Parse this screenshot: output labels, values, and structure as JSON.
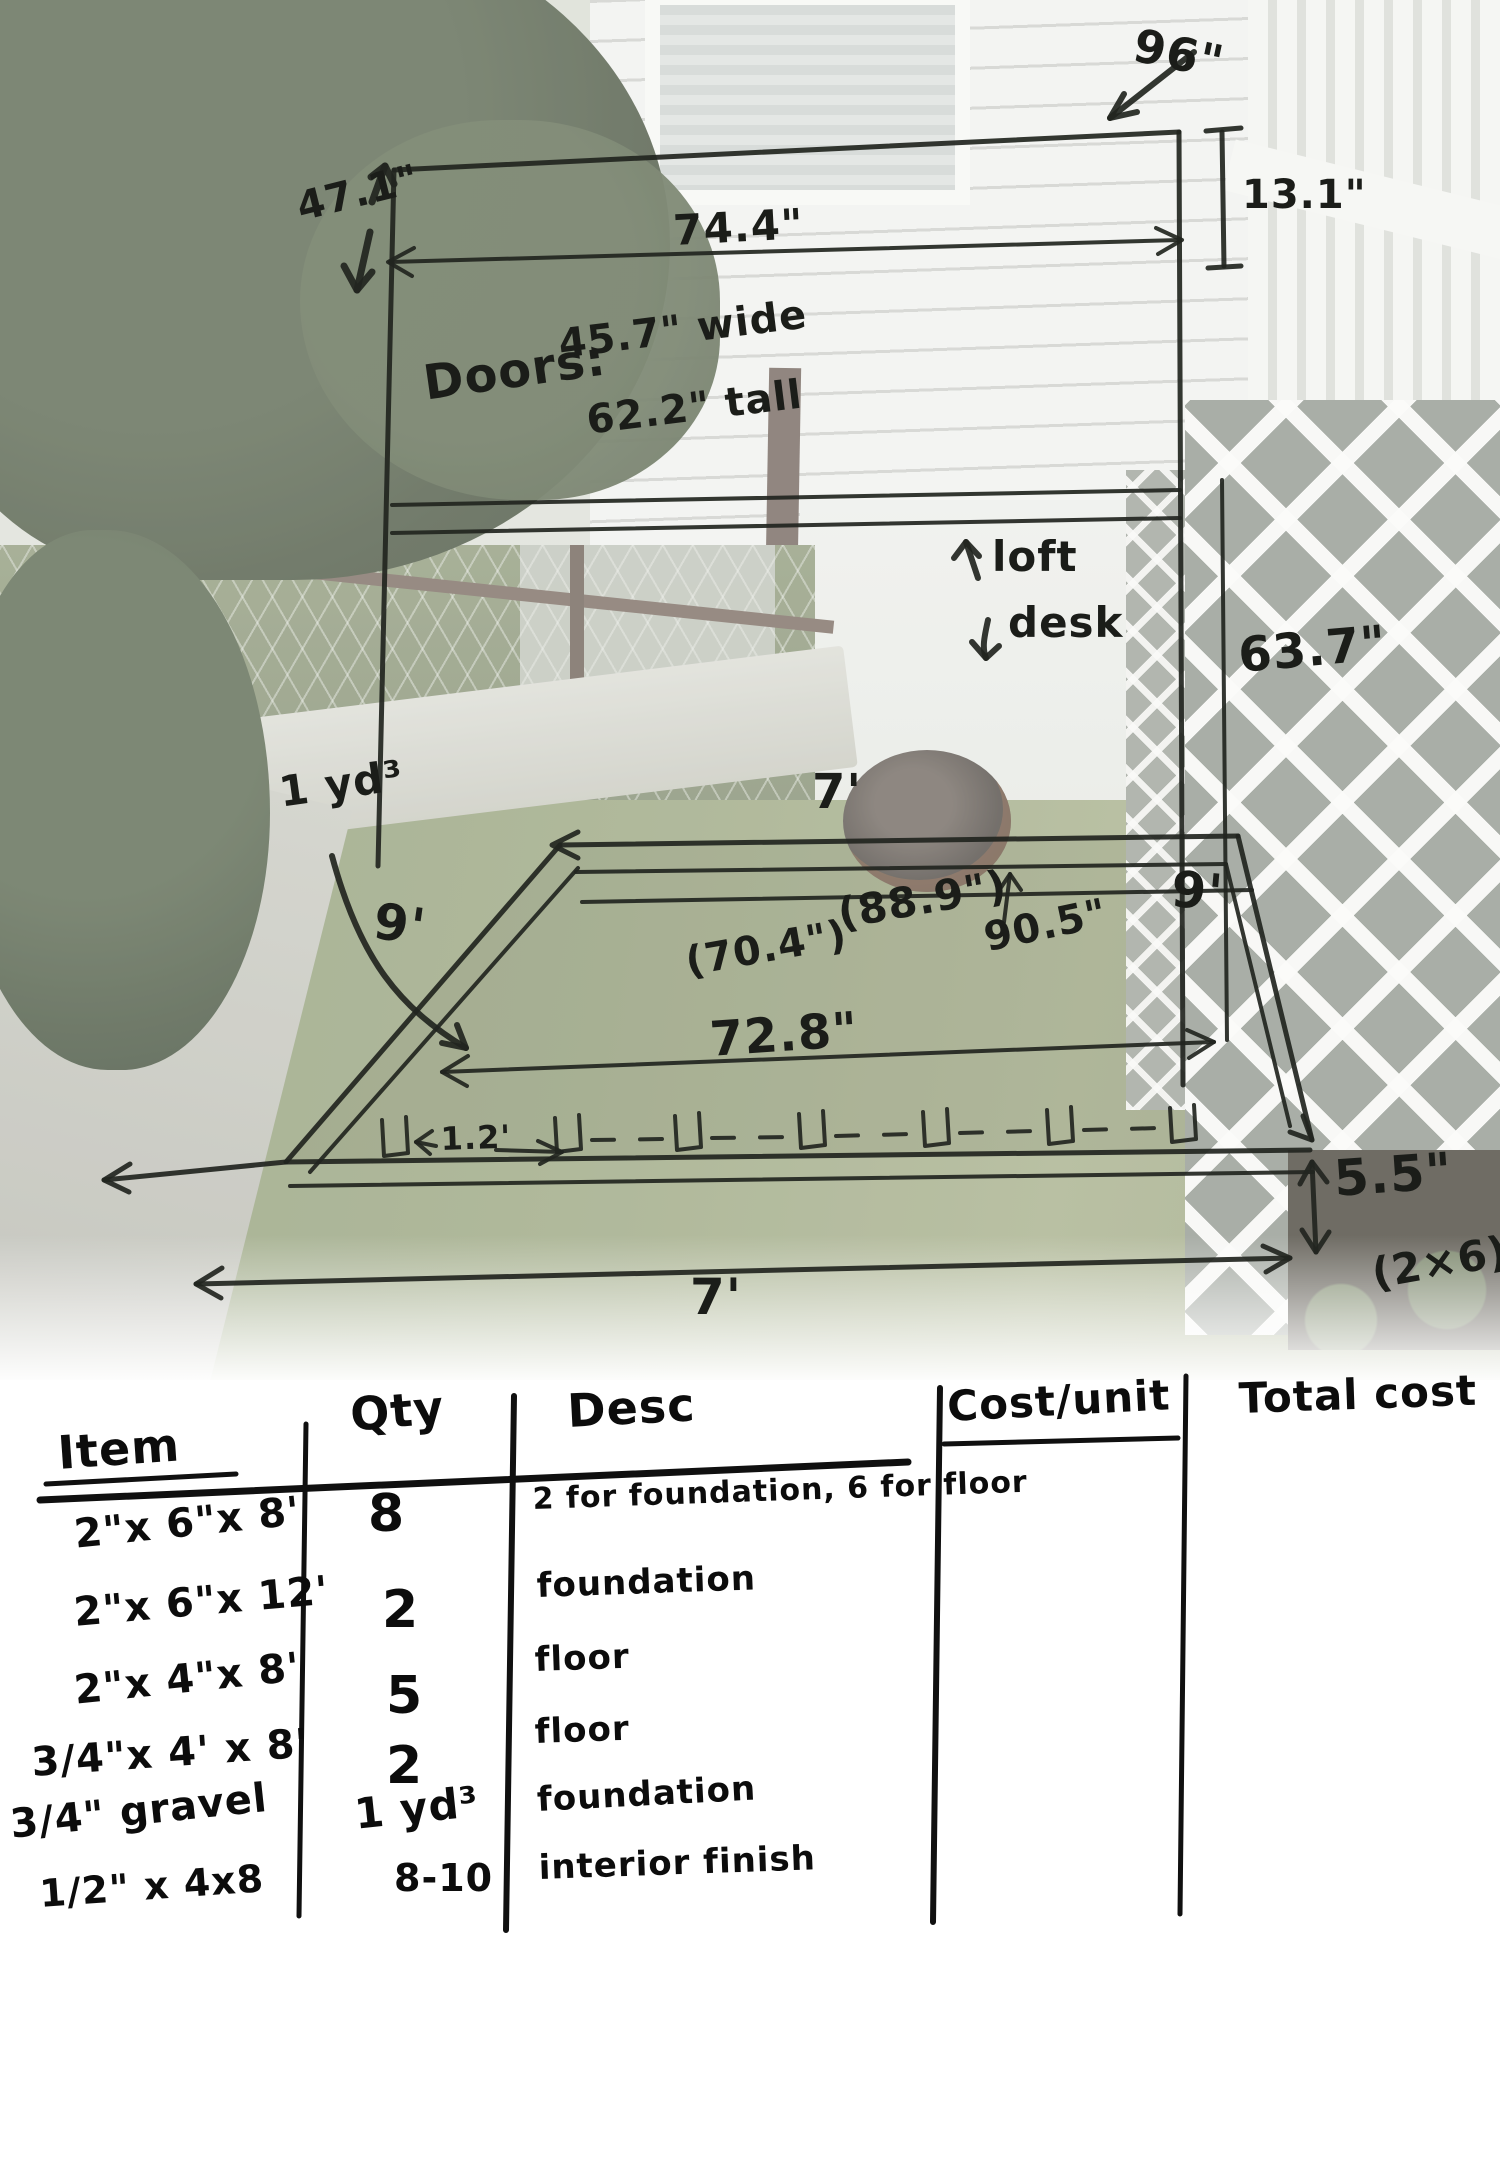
{
  "colors": {
    "ink": "#22251f",
    "table_ink": "#101010",
    "paper": "#ffffff"
  },
  "sketch": {
    "labels": {
      "height_left": "47.1\"",
      "width_top": "74.4\"",
      "depth_top": "96\"",
      "top_offset": "13.1\"",
      "doors_label": "Doors:",
      "doors_width": "45.7\" wide",
      "doors_height": "62.2\" tall",
      "loft": "loft",
      "desk": "desk",
      "wall_height": "63.7\"",
      "gravel_volume": "1 yd³",
      "back_width": "7'",
      "left_depth": "9'",
      "right_depth": "9'",
      "inner_front": "(70.4\")",
      "inner_back": "(88.9\")",
      "diagonal": "90.5\"",
      "inner_mid": "72.8\"",
      "joist_offset": "1.2'",
      "board_height": "5.5\"",
      "board_size": "(2×6)",
      "front_width": "7'"
    }
  },
  "table": {
    "headers": {
      "item": "Item",
      "qty": "Qty",
      "desc": "Desc",
      "cost_unit": "Cost/unit",
      "total_cost": "Total cost"
    },
    "rows": [
      {
        "item": "2\"x 6\"x 8'",
        "qty": "8",
        "desc": "2 for foundation, 6 for floor"
      },
      {
        "item": "2\"x 6\"x 12'",
        "qty": "2",
        "desc": "foundation"
      },
      {
        "item": "2\"x 4\"x 8'",
        "qty": "5",
        "desc": "floor"
      },
      {
        "item": "3/4\"x 4' x 8'",
        "qty": "2",
        "desc": "floor"
      },
      {
        "item": "3/4\" gravel",
        "qty": "1 yd³",
        "desc": "foundation"
      },
      {
        "item": "1/2\" x 4x8",
        "qty": "8-10",
        "desc": "interior finish"
      }
    ]
  }
}
